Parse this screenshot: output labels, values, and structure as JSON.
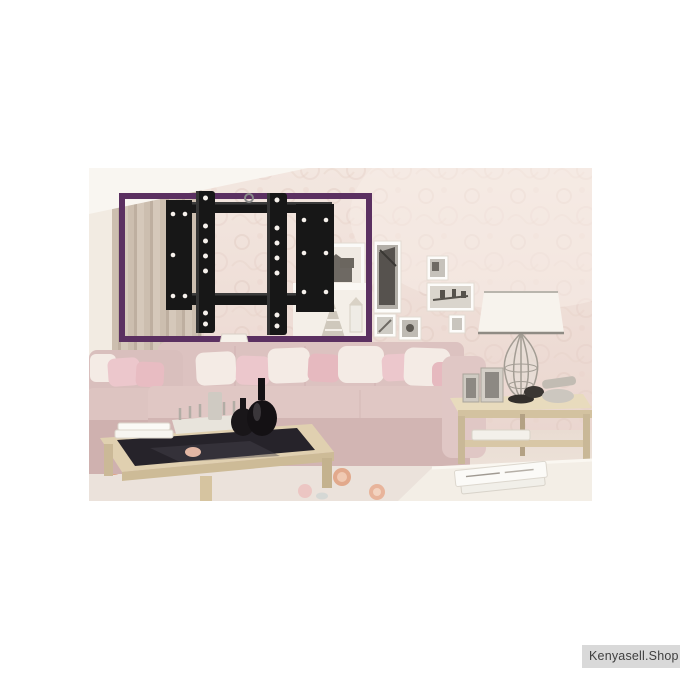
{
  "image": {
    "type": "product-photo",
    "scene": "living room with wall-mounted TV bracket highlighted by purple rectangle",
    "product_name": "tv-wall-mount-bracket"
  },
  "colors": {
    "page_bg": "#ffffff",
    "highlight_box": "#5b3061",
    "bracket_black": "#171717",
    "bracket_hole": "#f6f1ec",
    "wall": "#eedcd5",
    "ceiling": "#f9f6f1",
    "curtain": "#cdbfb0",
    "sofa_pink": "#dcc2c0",
    "pillow_white": "#f4ebe5",
    "pillow_pink": "#ecc7cc",
    "table_wood": "#e0d0b0",
    "glass_top": "#26232a",
    "lamp_shade": "#f7f3ed",
    "rug": "#ebe2db",
    "rug_flower": "#dfa285",
    "watermark_bg": "#d9d9d9",
    "watermark_text": "#3f3f3f"
  },
  "watermark": {
    "label": "Kenyasell.Shop"
  }
}
